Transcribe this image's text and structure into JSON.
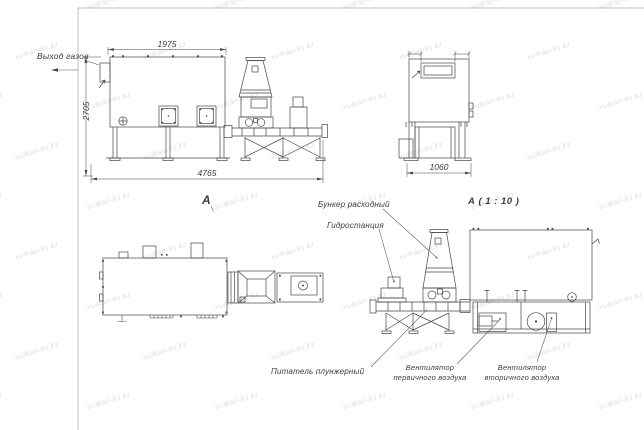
{
  "meta": {
    "type": "engineering-drawing",
    "line_color": "#474747",
    "background": "#ffffff"
  },
  "watermark": {
    "text": "vulkan-kv.kz",
    "rows": 9,
    "cols": 6
  },
  "labels": {
    "gas_outlet": "Выход газов",
    "view_marker": "А",
    "detail_title": "А ( 1 : 10 )",
    "hopper": "Бункер расходный",
    "hydraulic_station": "Гидростанция",
    "plunger_feeder": "Питатель плунжерный",
    "primary_fan": "Вентилятор\nпервичного воздуха",
    "secondary_fan": "Вентилятор\nвторичного воздуха"
  },
  "dimensions": {
    "front_width_top": "1975",
    "front_height": "2705",
    "front_length_total": "4765",
    "side_width": "1060"
  }
}
